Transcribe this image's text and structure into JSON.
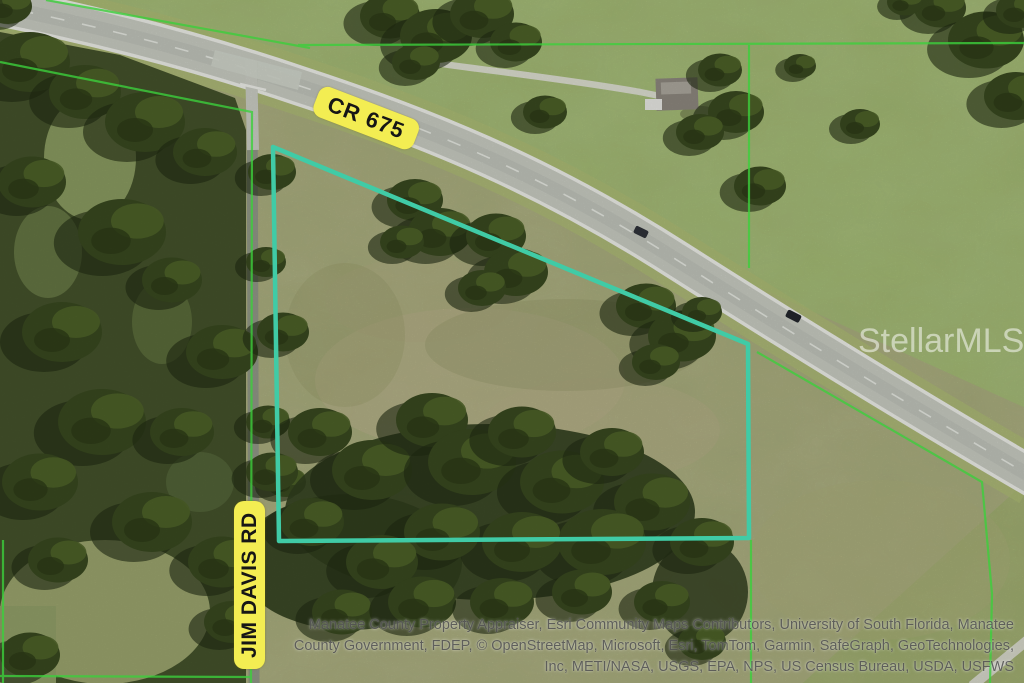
{
  "map": {
    "labels": {
      "highway": "CR 675",
      "side_road": "JIM DAVIS RD"
    },
    "watermark": "StellarMLS",
    "attribution": {
      "line1": "Manatee County Property Appraiser, Esri Community Maps Contributors, University of South Florida, Manatee",
      "line2": "County Government, FDEP, © OpenStreetMap, Microsoft, Esri, TomTom, Garmin, SafeGraph, GeoTechnologies,",
      "line3": "Inc, METI/NASA, USGS, EPA, NPS, US Census Bureau, USDA, USFWS"
    },
    "colors": {
      "parcel_highlight": "#40cba6",
      "parcel_line": "#3ccf3c",
      "road_label_bg": "#f3ed52",
      "road_label_text": "#161616",
      "watermark_text": "#ffffff"
    }
  }
}
